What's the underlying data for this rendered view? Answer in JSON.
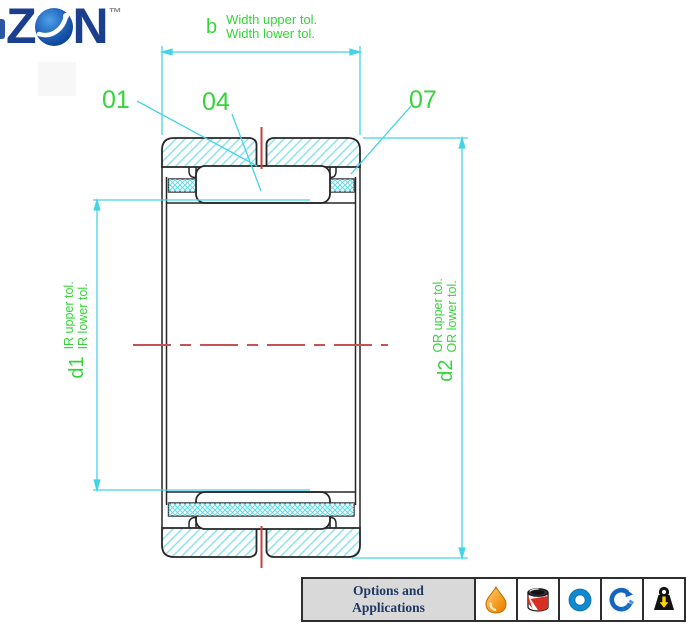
{
  "logo": {
    "left": "Z",
    "right": "N",
    "tm": "™",
    "globe_icon": "globe"
  },
  "drawing": {
    "type": "needle-roller-bearing-cross-section",
    "colors": {
      "dimension_cyan": "#45d3e6",
      "hatch_cyan": "#86e3ee",
      "crosshatch_cyan": "#5fdbe8",
      "centerline_red": "#c65353",
      "lube_hole_red": "#c94040",
      "outline_black": "#262626",
      "label_green": "#35d53a"
    },
    "ref_labels": {
      "r01": "01",
      "r04": "04",
      "r07": "07"
    },
    "width_dim": {
      "symbol": "b",
      "upper_tol": "Width upper tol.",
      "lower_tol": "Width lower tol."
    },
    "inner_dim": {
      "symbol": "d1",
      "upper_tol": "IR upper tol.",
      "lower_tol": "IR lower tol."
    },
    "outer_dim": {
      "symbol": "d2",
      "upper_tol": "OR upper tol.",
      "lower_tol": "OR lower tol."
    }
  },
  "footer": {
    "title_line1": "Options and",
    "title_line2": "Applications",
    "icons": [
      "oil-drop",
      "grease-tin",
      "bearing-ring",
      "rotation",
      "load-weight"
    ]
  }
}
